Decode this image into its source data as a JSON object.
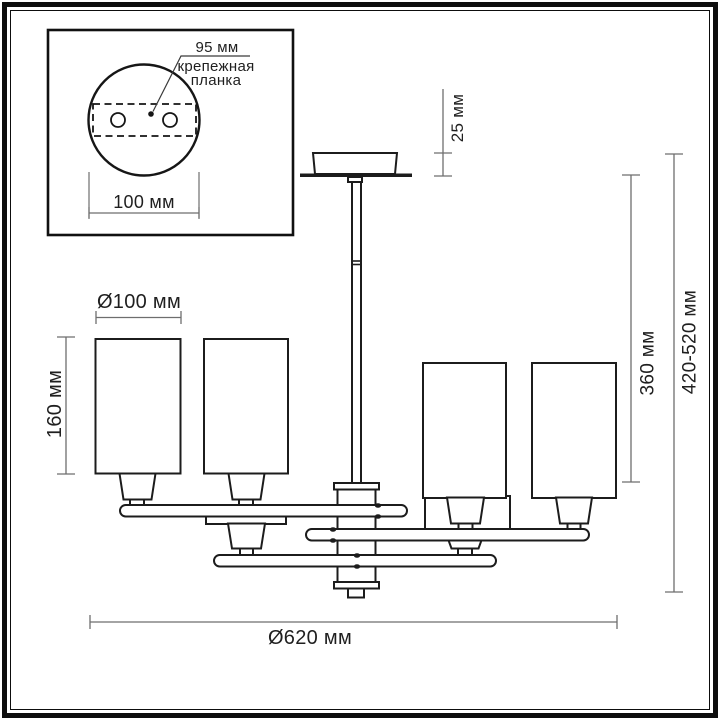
{
  "title": "chandelier-dimension-drawing",
  "inset": {
    "plate_width_label": "95 мм",
    "plate_name_line1": "крепежная",
    "plate_name_line2": "планка",
    "canopy_diameter_label": "100 мм"
  },
  "dimensions": {
    "canopy_height": "25 мм",
    "shade_diameter": "Ø100 мм",
    "shade_height": "160 мм",
    "rod_drop": "360 мм",
    "total_height": "420-520 мм",
    "fixture_diameter": "Ø620 мм"
  },
  "colors": {
    "line": "#1c1c1c",
    "dimension_line": "#6e6e6e",
    "text": "#1f1f1f",
    "background": "#ffffff"
  }
}
